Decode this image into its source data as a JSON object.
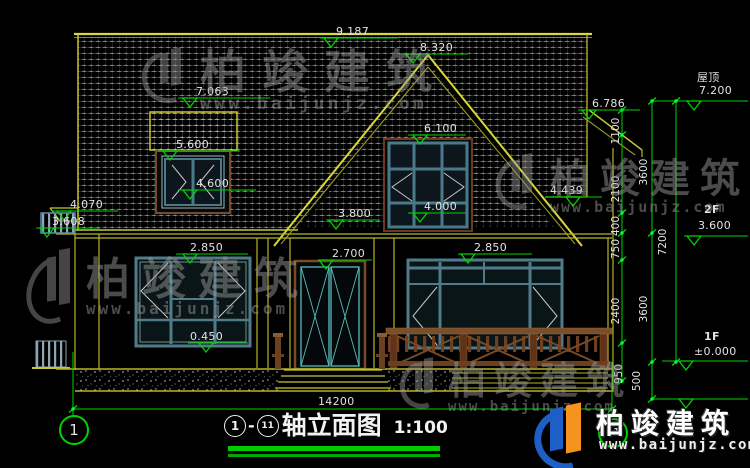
{
  "drawing": {
    "title": "轴立面图",
    "scale": "1:100",
    "axis_start": "1",
    "axis_end": "11",
    "separator": "-"
  },
  "levels": {
    "ridge": "9.187",
    "gable_peak": "8.320",
    "dormer_roof": "7.063",
    "dormer_window_top": "5.600",
    "dormer_window_sill": "4.600",
    "left_eave": "4.070",
    "left_canopy": "3.608",
    "gable_window_top": "6.100",
    "gable_window_sill": "4.000",
    "upper_wall": "3.800",
    "window_left_top": "2.850",
    "door_top": "2.700",
    "window_left_sill": "0.450",
    "window_right_top": "2.850",
    "right_eave": "6.786",
    "right_slope_end": "4.439",
    "roof_label": "屋顶",
    "roof_level": "7.200",
    "floor2_label": "2F",
    "floor2_level": "3.600",
    "floor1_label": "1F",
    "floor1_level": "±0.000"
  },
  "dims": {
    "total_width": "14200",
    "total_height": "7200",
    "seg_1100": "1100",
    "seg_2100": "2100",
    "seg_400": "400",
    "seg_750": "750",
    "seg_2400": "2400",
    "seg_950": "950",
    "seg_3600_upper": "3600",
    "seg_3600_lower": "3600",
    "seg_500": "500"
  },
  "watermark": {
    "brand": "柏竣建筑",
    "url": "www.baijunjz.com"
  },
  "colors": {
    "background": "#000000",
    "line_yellow": "#b5b526",
    "dim_green": "#00d400",
    "frame_teal": "#517b8a",
    "wood_brown": "#7a4a22",
    "text": "#e2e2e2"
  }
}
